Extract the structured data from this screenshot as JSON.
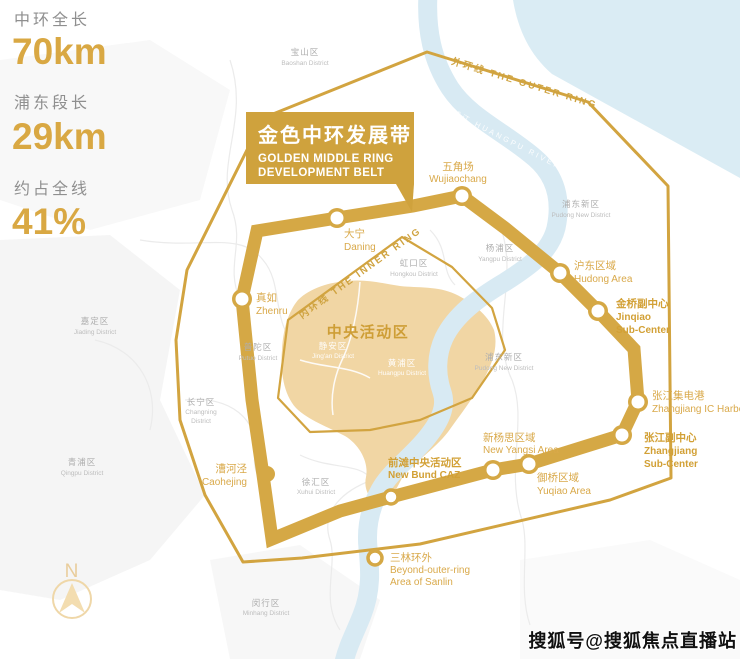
{
  "stats": {
    "items": [
      {
        "label": "中环全长",
        "value": "70km"
      },
      {
        "label": "浦东段长",
        "value": "29km"
      },
      {
        "label": "约占全线",
        "value": "41%"
      }
    ]
  },
  "banner": {
    "title": "金色中环发展带",
    "en1": "GOLDEN MIDDLE RING",
    "en2": "DEVELOPMENT BELT"
  },
  "rings": {
    "outer": "外环线  THE OUTER RING",
    "inner": "内环线 THE INNER RING"
  },
  "river": {
    "label": "黄浦江 HUANGPU RIVER"
  },
  "caz": {
    "label": "中央活动区"
  },
  "nodes": [
    {
      "cn": "大宁",
      "en1": "Daning"
    },
    {
      "cn": "五角场",
      "en1": "Wujiaochang"
    },
    {
      "cn": "真如",
      "en1": "Zhenru"
    },
    {
      "cn": "沪东区域",
      "en1": "Hudong Area"
    },
    {
      "cn": "金桥副中心",
      "en1": "Jinqiao",
      "en2": "Sub-Center"
    },
    {
      "cn": "张江集电港",
      "en1": "Zhangjiang IC Harbor"
    },
    {
      "cn": "张江副中心",
      "en1": "Zhangjiang",
      "en2": "Sub-Center"
    },
    {
      "cn": "新杨思区域",
      "en1": "New Yangsi Area"
    },
    {
      "cn": "御桥区域",
      "en1": "Yuqiao Area"
    },
    {
      "cn": "前滩中央活动区",
      "en1": "New Bund CAZ"
    },
    {
      "cn": "漕河泾",
      "en1": "Caohejing"
    },
    {
      "cn": "三林环外",
      "en1": "Beyond-outer-ring",
      "en2": "Area of Sanlin"
    }
  ],
  "districts": [
    {
      "cn": "宝山区",
      "en1": "Baoshan District"
    },
    {
      "cn": "嘉定区",
      "en1": "Jiading District"
    },
    {
      "cn": "青浦区",
      "en1": "Qingpu District"
    },
    {
      "cn": "长宁区",
      "en1": "Changning",
      "en2": "District"
    },
    {
      "cn": "普陀区",
      "en1": "Putuo District"
    },
    {
      "cn": "虹口区",
      "en1": "Hongkou District"
    },
    {
      "cn": "杨浦区",
      "en1": "Yangpu District"
    },
    {
      "cn": "浦东新区",
      "en1": "Pudong New District"
    },
    {
      "cn": "浦东新区",
      "en1": "Pudong New District"
    },
    {
      "cn": "徐汇区",
      "en1": "Xuhui District"
    },
    {
      "cn": "闵行区",
      "en1": "Minhang District"
    },
    {
      "cn": "静安区",
      "en1": "Jing'an District"
    },
    {
      "cn": "黄浦区",
      "en1": "Huangpu District"
    }
  ],
  "compass": {
    "label": "N"
  },
  "watermark": {
    "text": "搜狐号@搜狐焦点直播站"
  },
  "colors": {
    "gold": "#D2A440",
    "band": "#D5A845",
    "tan": "#F1D6A4",
    "river": "#D8EAF3",
    "estuary": "#DAECF4"
  }
}
